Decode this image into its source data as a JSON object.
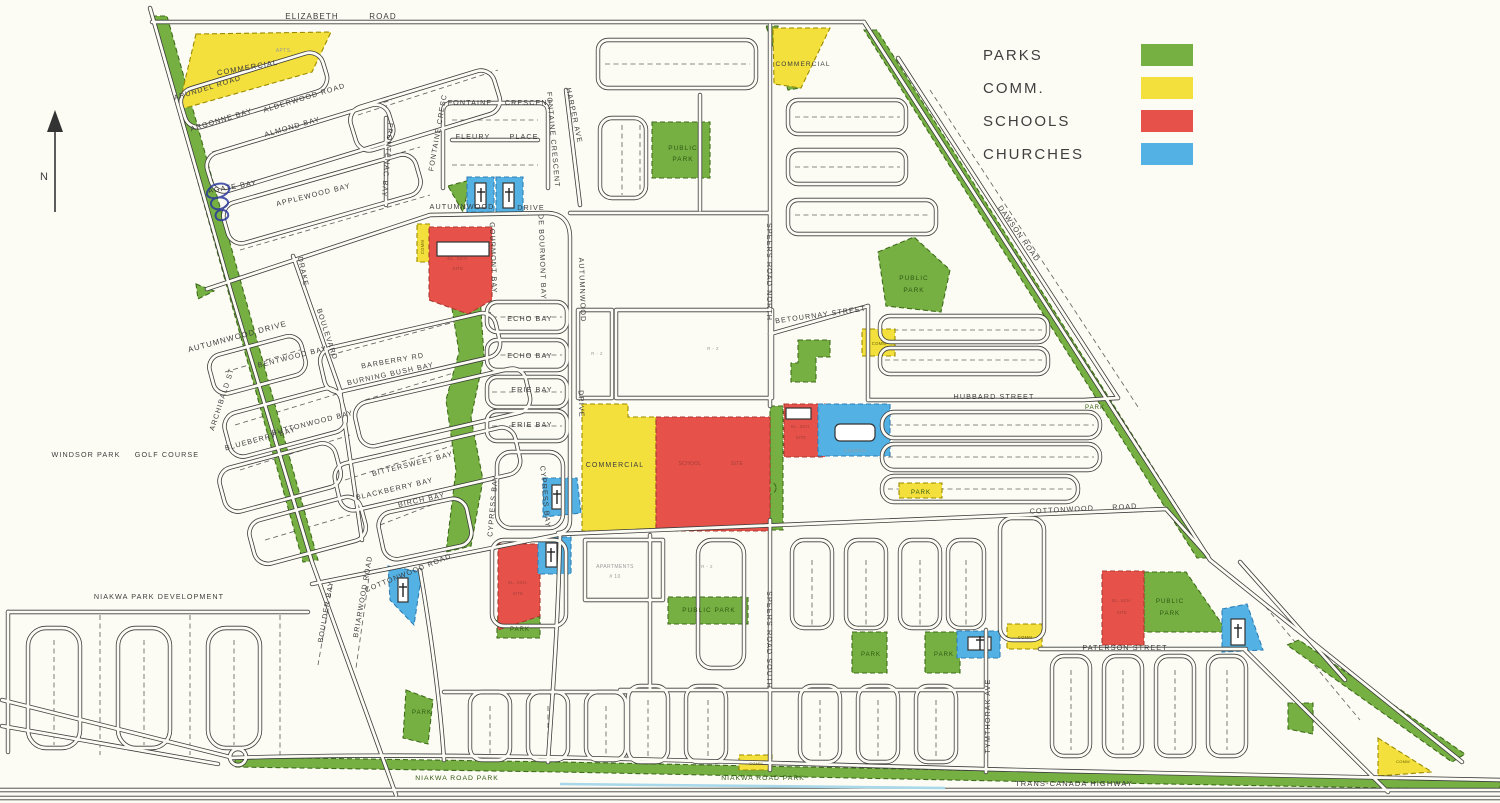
{
  "colors": {
    "park": "#76b043",
    "comm": "#f3e03c",
    "school": "#e6514a",
    "church": "#54b1e3",
    "road_ink": "#3c3c3c",
    "paper": "#fdfcf4",
    "ink_scribble": "#2b3a9c",
    "water": "#a8d8ea"
  },
  "legend": {
    "items": [
      {
        "label": "PARKS",
        "type": "park"
      },
      {
        "label": "COMM.",
        "type": "comm"
      },
      {
        "label": "SCHOOLS",
        "type": "school"
      },
      {
        "label": "CHURCHES",
        "type": "church"
      }
    ]
  },
  "compass": {
    "label": "N"
  },
  "labels": [
    {
      "t": "ELIZABETH",
      "x": 312,
      "y": 19,
      "s": 8
    },
    {
      "t": "ROAD",
      "x": 383,
      "y": 19,
      "s": 8
    },
    {
      "t": "ARUNDEL ROAD",
      "x": 208,
      "y": 90,
      "r": -17
    },
    {
      "t": "ALDERWOOD ROAD",
      "x": 305,
      "y": 100,
      "r": -17
    },
    {
      "t": "ARGONNE BAY",
      "x": 222,
      "y": 122,
      "r": -17
    },
    {
      "t": "ALMOND BAY",
      "x": 293,
      "y": 129,
      "r": -16
    },
    {
      "t": "AGATE BAY",
      "x": 233,
      "y": 189,
      "r": -10
    },
    {
      "t": "APPLEWOOD BAY",
      "x": 314,
      "y": 197,
      "r": -14
    },
    {
      "t": "FRONTENAC BAY",
      "x": 385,
      "y": 160,
      "r": 95
    },
    {
      "t": "FONTAINE",
      "x": 470,
      "y": 105
    },
    {
      "t": "CRESCENT",
      "x": 529,
      "y": 105
    },
    {
      "t": "FLEURY",
      "x": 473,
      "y": 139
    },
    {
      "t": "PLACE",
      "x": 524,
      "y": 139
    },
    {
      "t": "FONTAINE CRESC",
      "x": 440,
      "y": 133,
      "r": -80
    },
    {
      "t": "FONTAINE CRESCENT",
      "x": 551,
      "y": 140,
      "r": 85
    },
    {
      "t": "HARPER AVE",
      "x": 572,
      "y": 116,
      "r": 78
    },
    {
      "t": "AUTUMNWOOD",
      "x": 462,
      "y": 209
    },
    {
      "t": "DRIVE",
      "x": 531,
      "y": 210
    },
    {
      "t": "AUTUMNWOOD DRIVE",
      "x": 238,
      "y": 339,
      "r": -15,
      "s": 7.8
    },
    {
      "t": "BARBERRY RD",
      "x": 393,
      "y": 363,
      "r": -10
    },
    {
      "t": "DRAKE",
      "x": 301,
      "y": 272,
      "r": 78
    },
    {
      "t": "BOULEVARD",
      "x": 325,
      "y": 335,
      "r": 72
    },
    {
      "t": "BLUEBERRY BAY",
      "x": 261,
      "y": 441,
      "r": -15
    },
    {
      "t": "BLACKBERRY BAY",
      "x": 395,
      "y": 491,
      "r": -13
    },
    {
      "t": "BENTWOOD BAY",
      "x": 293,
      "y": 359,
      "r": -14
    },
    {
      "t": "BURNING BUSH BAY",
      "x": 391,
      "y": 376,
      "r": -12
    },
    {
      "t": "BUTTONWOOD BAY",
      "x": 313,
      "y": 425,
      "r": -14
    },
    {
      "t": "BITTERSWEET BAY",
      "x": 413,
      "y": 466,
      "r": -14
    },
    {
      "t": "BIRCH BAY",
      "x": 422,
      "y": 502,
      "r": -12
    },
    {
      "t": "BOULDER BAY",
      "x": 328,
      "y": 612,
      "r": -80
    },
    {
      "t": "BRIARWOOD ROAD",
      "x": 365,
      "y": 597,
      "r": -80
    },
    {
      "t": "ARCHIBALD ST",
      "x": 224,
      "y": 400,
      "r": -72
    },
    {
      "t": "GOURMONT BAY",
      "x": 491,
      "y": 258,
      "r": 88
    },
    {
      "t": "DE BOURMONT BAY",
      "x": 540,
      "y": 257,
      "r": 88
    },
    {
      "t": "AUTUMNWOOD",
      "x": 580,
      "y": 290,
      "r": 88
    },
    {
      "t": "DRIVE",
      "x": 579,
      "y": 404,
      "r": 88
    },
    {
      "t": "ECHO BAY",
      "x": 530,
      "y": 321
    },
    {
      "t": "ECHO BAY",
      "x": 530,
      "y": 358
    },
    {
      "t": "ERIE BAY",
      "x": 532,
      "y": 392
    },
    {
      "t": "ERIE BAY",
      "x": 532,
      "y": 427
    },
    {
      "t": "CYPRESS BAY",
      "x": 495,
      "y": 506,
      "r": -85
    },
    {
      "t": "CYPRESS BAY",
      "x": 543,
      "y": 497,
      "r": 85
    },
    {
      "t": "COTTONWOOD ROAD",
      "x": 409,
      "y": 575,
      "r": -22
    },
    {
      "t": "COTTONWOOD",
      "x": 1062,
      "y": 512,
      "r": -3
    },
    {
      "t": "ROAD",
      "x": 1125,
      "y": 509,
      "r": -3
    },
    {
      "t": "SPEERS ROAD NORTH",
      "x": 767,
      "y": 272,
      "r": 90
    },
    {
      "t": "SPEERS ROAD SOUTH",
      "x": 767,
      "y": 640,
      "r": 90
    },
    {
      "t": "BETOURNAY STREET",
      "x": 821,
      "y": 317,
      "r": -8
    },
    {
      "t": "HUBBARD STREET",
      "x": 994,
      "y": 399
    },
    {
      "t": "DAWSON ROAD",
      "x": 1017,
      "y": 235,
      "r": 55
    },
    {
      "t": "PATERSON STREET",
      "x": 1125,
      "y": 650
    },
    {
      "t": "TYMTHORAK AVE",
      "x": 990,
      "y": 716,
      "r": -90
    },
    {
      "t": "WINDSOR PARK",
      "x": 86,
      "y": 457
    },
    {
      "t": "GOLF COURSE",
      "x": 167,
      "y": 457
    },
    {
      "t": "NIAKWA PARK DEVELOPMENT",
      "x": 159,
      "y": 599
    },
    {
      "t": "NIAKWA ROAD PARK",
      "x": 457,
      "y": 780,
      "s": 6.8,
      "c": "pk"
    },
    {
      "t": "NIAKWA ROAD PARK",
      "x": 763,
      "y": 780,
      "s": 6.8,
      "c": "pk"
    },
    {
      "t": "TRANS-CANADA HIGHWAY",
      "x": 1074,
      "y": 786,
      "s": 7.5
    },
    {
      "t": "PUBLIC",
      "x": 683,
      "y": 150,
      "s": 6.5,
      "c": "pk"
    },
    {
      "t": "PARK",
      "x": 683,
      "y": 161,
      "s": 6.5,
      "c": "pk"
    },
    {
      "t": "PUBLIC",
      "x": 914,
      "y": 280,
      "s": 6.5,
      "c": "pk"
    },
    {
      "t": "PARK",
      "x": 914,
      "y": 292,
      "s": 6.5,
      "c": "pk"
    },
    {
      "t": "PUBLIC PARK",
      "x": 709,
      "y": 612,
      "s": 6.5,
      "c": "pk"
    },
    {
      "t": "PUBLIC",
      "x": 1170,
      "y": 603,
      "s": 6.2,
      "c": "pk"
    },
    {
      "t": "PARK",
      "x": 1170,
      "y": 615,
      "s": 6.2,
      "c": "pk"
    },
    {
      "t": "PARK",
      "x": 921,
      "y": 494,
      "s": 6,
      "c": "pk"
    },
    {
      "t": "PARK",
      "x": 1095,
      "y": 409,
      "s": 6,
      "c": "pk"
    },
    {
      "t": "PARK",
      "x": 520,
      "y": 631,
      "s": 6,
      "c": "pk"
    },
    {
      "t": "PARK",
      "x": 871,
      "y": 656,
      "s": 6,
      "c": "pk"
    },
    {
      "t": "PARK",
      "x": 944,
      "y": 656,
      "s": 6,
      "c": "pk"
    },
    {
      "t": "PARK",
      "x": 422,
      "y": 714,
      "s": 6,
      "c": "pk"
    },
    {
      "t": "COMMERCIAL",
      "x": 248,
      "y": 70,
      "r": -10,
      "s": 7.5
    },
    {
      "t": "COMMERCIAL",
      "x": 803,
      "y": 66,
      "s": 6.5
    },
    {
      "t": "COMMERCIAL",
      "x": 615,
      "y": 467,
      "s": 7
    },
    {
      "t": "COMM",
      "x": 424,
      "y": 247,
      "r": -90,
      "s": 4.2,
      "c": "tiny"
    },
    {
      "t": "COMM",
      "x": 879,
      "y": 345,
      "s": 4.2,
      "c": "tiny"
    },
    {
      "t": "COMM",
      "x": 1025,
      "y": 639,
      "s": 4.2,
      "c": "tiny"
    },
    {
      "t": "COMM",
      "x": 756,
      "y": 765,
      "s": 4,
      "c": "tiny"
    },
    {
      "t": "COMM",
      "x": 1403,
      "y": 763,
      "s": 4,
      "c": "tiny"
    },
    {
      "t": "CHURCH",
      "x": 855,
      "y": 452,
      "s": 4.5,
      "c": "faint"
    },
    {
      "t": "APTS.",
      "x": 284,
      "y": 52,
      "s": 5,
      "c": "faint"
    },
    {
      "t": "APARTMENTS",
      "x": 615,
      "y": 568,
      "s": 5,
      "c": "faint"
    },
    {
      "t": "# 10",
      "x": 615,
      "y": 578,
      "s": 5,
      "c": "faint"
    },
    {
      "t": "R - 2",
      "x": 597,
      "y": 355,
      "s": 4.5,
      "c": "faint"
    },
    {
      "t": "R - 2",
      "x": 713,
      "y": 350,
      "s": 4.5,
      "c": "faint"
    },
    {
      "t": "R - 2",
      "x": 707,
      "y": 568,
      "s": 4.5,
      "c": "faint"
    },
    {
      "t": "EL. SCH.",
      "x": 458,
      "y": 260,
      "s": 4.5,
      "c": "fr"
    },
    {
      "t": "SITE",
      "x": 458,
      "y": 270,
      "s": 4.5,
      "c": "fr"
    },
    {
      "t": "SCHOOL",
      "x": 690,
      "y": 465,
      "s": 5,
      "c": "fr"
    },
    {
      "t": "SITE",
      "x": 737,
      "y": 465,
      "s": 5,
      "c": "fr"
    },
    {
      "t": "EL. SCH.",
      "x": 801,
      "y": 428,
      "s": 4.2,
      "c": "fr"
    },
    {
      "t": "SITE",
      "x": 801,
      "y": 439,
      "s": 4.2,
      "c": "fr"
    },
    {
      "t": "EL. SCH.",
      "x": 518,
      "y": 584,
      "s": 4.2,
      "c": "fr"
    },
    {
      "t": "SITE",
      "x": 518,
      "y": 595,
      "s": 4.2,
      "c": "fr"
    },
    {
      "t": "EL. SCH.",
      "x": 1122,
      "y": 602,
      "s": 4.2,
      "c": "fr"
    },
    {
      "t": "SITE",
      "x": 1122,
      "y": 614,
      "s": 4.2,
      "c": "fr"
    }
  ],
  "zones": [
    {
      "type": "park",
      "shape": "poly",
      "pts": "152,16 167,16 318,560 303,562"
    },
    {
      "type": "park",
      "shape": "rect",
      "x": 652,
      "y": 122,
      "w": 58,
      "h": 56
    },
    {
      "type": "park",
      "shape": "poly",
      "pts": "878,252 914,237 950,270 941,312 886,306"
    },
    {
      "type": "park",
      "shape": "poly",
      "pts": "864,30 877,30 1210,558 1197,558"
    },
    {
      "type": "park",
      "shape": "poly",
      "pts": "766,26 778,26 800,88 788,90"
    },
    {
      "type": "park",
      "shape": "poly",
      "pts": "1287,645 1299,640 1465,754 1452,762"
    },
    {
      "type": "park",
      "shape": "poly",
      "pts": "450,296 480,296 484,356 471,418 483,480 471,546 446,552 456,470 446,400 459,352"
    },
    {
      "type": "park",
      "shape": "rect",
      "x": 770,
      "y": 406,
      "w": 13,
      "h": 124
    },
    {
      "type": "park",
      "shape": "poly",
      "pts": "798,340 830,340 830,357 816,357 816,382 791,382 791,363 798,363"
    },
    {
      "type": "park",
      "shape": "rect",
      "x": 668,
      "y": 597,
      "w": 80,
      "h": 27
    },
    {
      "type": "park",
      "shape": "rect",
      "x": 852,
      "y": 632,
      "w": 35,
      "h": 41
    },
    {
      "type": "park",
      "shape": "rect",
      "x": 925,
      "y": 632,
      "w": 35,
      "h": 41
    },
    {
      "type": "park",
      "shape": "poly",
      "pts": "1144,572 1186,572 1224,627 1222,632 1144,632"
    },
    {
      "type": "park",
      "shape": "poly",
      "pts": "406,690 433,700 428,744 403,738"
    },
    {
      "type": "park",
      "shape": "rect",
      "x": 497,
      "y": 617,
      "w": 43,
      "h": 21
    },
    {
      "type": "park",
      "shape": "poly",
      "pts": "235,757 560,762 1000,771 1500,779 1500,790 1000,781 560,772 235,767"
    },
    {
      "type": "park",
      "shape": "poly",
      "pts": "1288,703 1313,703 1313,734 1288,729"
    },
    {
      "type": "park",
      "shape": "circle",
      "cx": 770,
      "cy": 488,
      "r": 6
    },
    {
      "type": "park",
      "shape": "poly",
      "pts": "196,284 214,291 198,299"
    },
    {
      "type": "park",
      "shape": "poly",
      "pts": "448,186 470,180 463,212"
    },
    {
      "type": "comm",
      "shape": "poly",
      "pts": "196,34 331,32 312,72 178,110"
    },
    {
      "type": "comm",
      "shape": "poly",
      "pts": "773,28 830,28 801,88 774,84"
    },
    {
      "type": "comm",
      "shape": "poly",
      "pts": "582,404 628,404 628,417 656,417 656,531 582,531"
    },
    {
      "type": "comm",
      "shape": "rect",
      "x": 417,
      "y": 224,
      "w": 13,
      "h": 38
    },
    {
      "type": "comm",
      "shape": "rect",
      "x": 862,
      "y": 329,
      "w": 33,
      "h": 27
    },
    {
      "type": "comm",
      "shape": "rect",
      "x": 1007,
      "y": 624,
      "w": 35,
      "h": 25
    },
    {
      "type": "comm",
      "shape": "rect",
      "x": 739,
      "y": 755,
      "w": 33,
      "h": 15
    },
    {
      "type": "comm",
      "shape": "poly",
      "pts": "1378,738 1432,772 1378,776"
    },
    {
      "type": "comm",
      "shape": "rect",
      "x": 899,
      "y": 483,
      "w": 43,
      "h": 15
    },
    {
      "type": "school",
      "shape": "poly",
      "pts": "429,227 492,227 492,300 468,314 429,300"
    },
    {
      "type": "school",
      "shape": "rect",
      "x": 656,
      "y": 417,
      "w": 114,
      "h": 114
    },
    {
      "type": "school",
      "shape": "rect",
      "x": 784,
      "y": 404,
      "w": 41,
      "h": 53
    },
    {
      "type": "school",
      "shape": "poly",
      "pts": "498,544 540,544 540,616 498,630"
    },
    {
      "type": "school",
      "shape": "rect",
      "x": 1102,
      "y": 571,
      "w": 42,
      "h": 74
    },
    {
      "type": "church",
      "shape": "rect",
      "x": 467,
      "y": 177,
      "w": 27,
      "h": 35
    },
    {
      "type": "church",
      "shape": "rect",
      "x": 496,
      "y": 177,
      "w": 27,
      "h": 35
    },
    {
      "type": "church",
      "shape": "poly",
      "pts": "543,478 577,478 581,513 543,517"
    },
    {
      "type": "church",
      "shape": "rect",
      "x": 538,
      "y": 537,
      "w": 33,
      "h": 37
    },
    {
      "type": "church",
      "shape": "rect",
      "x": 818,
      "y": 404,
      "w": 72,
      "h": 52
    },
    {
      "type": "church",
      "shape": "rect",
      "x": 957,
      "y": 631,
      "w": 43,
      "h": 27
    },
    {
      "type": "church",
      "shape": "poly",
      "pts": "1222,609 1247,604 1263,650 1222,652"
    },
    {
      "type": "church",
      "shape": "poly",
      "pts": "388,566 422,572 414,625 390,600"
    },
    {
      "type": "footprint",
      "shape": "rect",
      "x": 437,
      "y": 242,
      "w": 52,
      "h": 14
    },
    {
      "type": "footprint",
      "shape": "rect",
      "x": 475,
      "y": 183,
      "w": 11,
      "h": 25
    },
    {
      "type": "footprint",
      "shape": "rect",
      "x": 503,
      "y": 183,
      "w": 11,
      "h": 25
    },
    {
      "type": "footprint",
      "shape": "rect",
      "x": 552,
      "y": 485,
      "w": 11,
      "h": 24
    },
    {
      "type": "footprint",
      "shape": "rect",
      "x": 546,
      "y": 543,
      "w": 11,
      "h": 24
    },
    {
      "type": "footprint",
      "shape": "rect",
      "x": 835,
      "y": 424,
      "w": 40,
      "h": 17,
      "rx": 5
    },
    {
      "type": "footprint",
      "shape": "rect",
      "x": 968,
      "y": 637,
      "w": 23,
      "h": 13
    },
    {
      "type": "footprint",
      "shape": "rect",
      "x": 1231,
      "y": 619,
      "w": 14,
      "h": 26
    },
    {
      "type": "footprint",
      "shape": "rect",
      "x": 786,
      "y": 408,
      "w": 25,
      "h": 11
    },
    {
      "type": "footprint",
      "shape": "rect",
      "x": 398,
      "y": 578,
      "w": 10,
      "h": 24
    }
  ],
  "crosses": [
    {
      "x": 481,
      "y": 195
    },
    {
      "x": 509,
      "y": 195
    },
    {
      "x": 557,
      "y": 497
    },
    {
      "x": 551,
      "y": 555
    },
    {
      "x": 980,
      "y": 643
    },
    {
      "x": 1238,
      "y": 631
    },
    {
      "x": 403,
      "y": 590
    }
  ]
}
